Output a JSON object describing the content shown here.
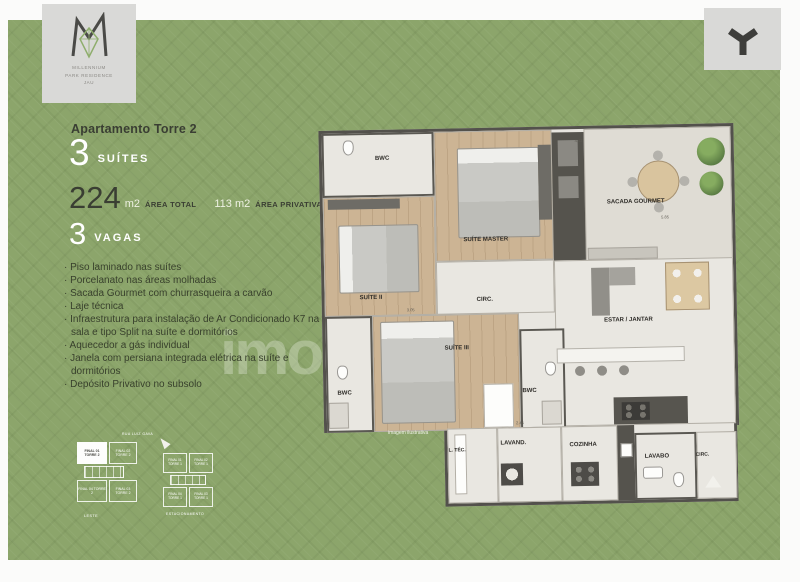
{
  "header": {
    "title": "Apartamento Torre 2"
  },
  "brand_left": {
    "line1": "MILLENNIUM",
    "line2": "PARK RESIDENCE",
    "line3": "JAU"
  },
  "specs": {
    "suites_value": "3",
    "suites_label": "SUÍTES",
    "area_total_value": "224",
    "area_total_unit": "m2",
    "area_total_label": "ÁREA TOTAL",
    "area_private_value": "113 m2",
    "area_private_label": "ÁREA PRIVATIVA",
    "vagas_value": "3",
    "vagas_label": "VAGAS"
  },
  "features": [
    "· Piso laminado nas suítes",
    "· Porcelanato nas áreas molhadas",
    "· Sacada Gourmet com churrasqueira a carvão",
    "· Laje técnica",
    "· Infraestrutura para instalação de Ar Condicionado K7 na sala e tipo Split na suíte e dormitórios",
    "· Aquecedor a gás individual",
    "· Janela com persiana integrada elétrica na suíte e dormitórios",
    "· Depósito Privativo no subsolo"
  ],
  "floorplan": {
    "labels": {
      "bwc_top": "BWC",
      "suite_master": "SUÍTE MASTER",
      "sacada": "SACADA GOURMET",
      "suite2": "SUÍTE II",
      "circ_mid": "CIRC.",
      "estar": "ESTAR / JANTAR",
      "suite3": "SUÍTE III",
      "bwc_left": "BWC",
      "bwc_right": "BWC",
      "ltec": "L. TÉC.",
      "lavand": "LAVAND.",
      "cozinha": "COZINHA",
      "lavabo": "LAVABO",
      "circ_entry": "CIRC."
    },
    "dims": {
      "sacada": "4.42",
      "estar": "5.85",
      "suite2": "3.05",
      "strip": "2.45"
    },
    "caption": "imagem ilustrativa"
  },
  "keyplans": {
    "left": {
      "street": "RUA LUIZ GAVA",
      "unit1": "FINAL 01 TORRE 2",
      "unit2": "FINAL 02 TORRE 2",
      "unit3": "FINAL 03 TORRE 2",
      "unit4": "FINAL 04 TORRE 2",
      "bottom": "LESTE"
    },
    "right": {
      "unit1": "FINAL 01 TORRE 1",
      "unit2": "FINAL 02 TORRE 1",
      "unit3": "FINAL 03 TORRE 1",
      "unit4": "FINAL 04 TORRE 1",
      "bottom": "ESTACIONAMENTO"
    }
  },
  "watermark": "imo",
  "colors": {
    "panel_green": "#8ca56b",
    "charcoal": "#3a3e33",
    "card_gray": "#d9d9d7",
    "wood": "#ccb494",
    "tile": "#e9e7e1"
  }
}
